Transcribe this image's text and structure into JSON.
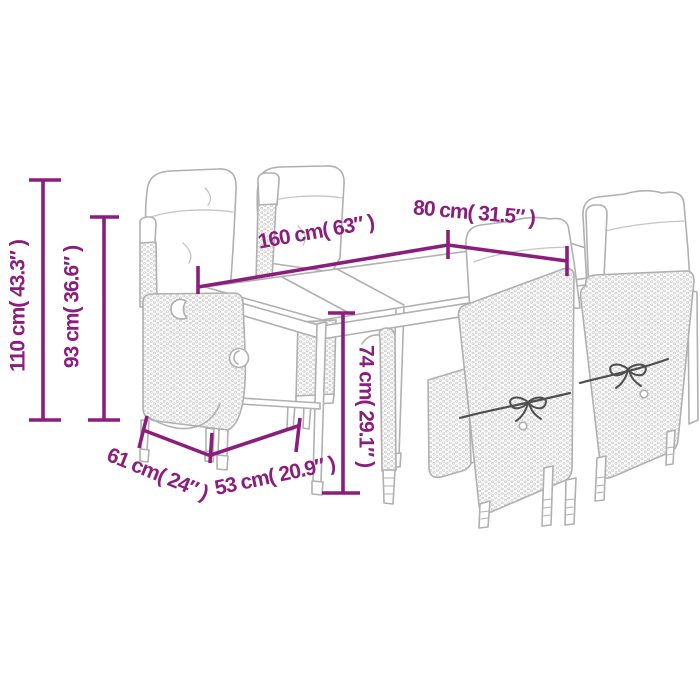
{
  "figure": {
    "type": "product-dimension-diagram",
    "subject": "garden dining set line drawing: rectangular table with four reclining poly-rattan chairs and seat cushions"
  },
  "colors": {
    "dimension": "#8b1d7d",
    "furniture_line": "#b0b0b0",
    "texture_dot": "#c6c6c6",
    "cord": "#4f4f4f",
    "background": "#ffffff"
  },
  "dims": {
    "d110": {
      "label": "110 cm( 43.3″ )",
      "cm": 110,
      "inch": 43.3,
      "orientation": "vertical"
    },
    "d93": {
      "label": "93 cm( 36.6″ )",
      "cm": 93,
      "inch": 36.6,
      "orientation": "vertical"
    },
    "d160": {
      "label": "160 cm( 63″ )",
      "cm": 160,
      "inch": 63,
      "orientation": "diagonal"
    },
    "d80": {
      "label": "80 cm( 31.5″ )",
      "cm": 80,
      "inch": 31.5,
      "orientation": "diagonal"
    },
    "d74": {
      "label": "74 cm( 29.1″ )",
      "cm": 74,
      "inch": 29.1,
      "orientation": "vertical"
    },
    "d61": {
      "label": "61 cm( 24″ )",
      "cm": 61,
      "inch": 24,
      "orientation": "diagonal"
    },
    "d53": {
      "label": "53 cm( 20.9″ )",
      "cm": 53,
      "inch": 20.9,
      "orientation": "diagonal"
    }
  }
}
